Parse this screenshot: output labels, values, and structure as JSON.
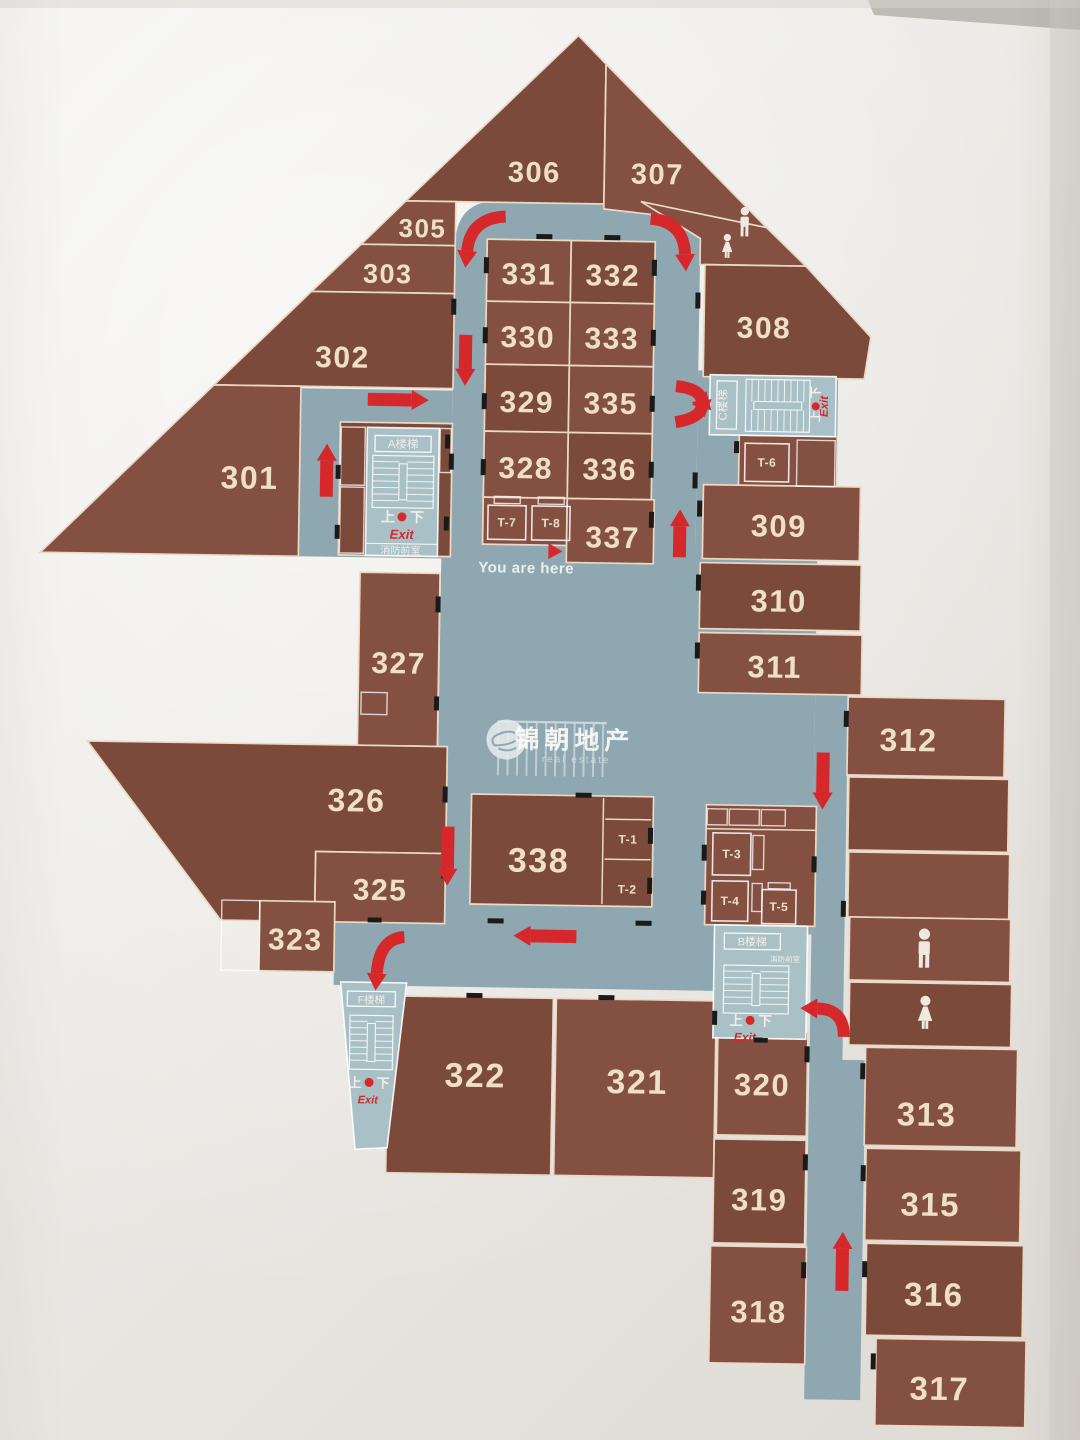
{
  "title": "3F floor plan directory",
  "palette": {
    "room": "#7c4a3b",
    "room_alt": "#835042",
    "corridor": "#8fa7b0",
    "stair_room": "#a9c0c7",
    "outline": "#ead9c4",
    "arrow_red": "#d6272b",
    "number_text": "#eedfc8",
    "black_door": "#1c1a18",
    "paper": "#eceae6"
  },
  "you_are_here": {
    "text": "You are here"
  },
  "labels": {
    "up": "上",
    "down": "下",
    "exit": "Exit",
    "fire_lobby": "消防前室",
    "stairA": "A楼梯",
    "stairB": "B楼梯",
    "stairC": "C楼梯",
    "stairF": "F楼梯"
  },
  "watermark": {
    "cn": "锦朝地产",
    "en": "real estate"
  },
  "rooms": [
    {
      "n": "306",
      "p": "575,35 603,63 603,203 405,203",
      "l": [
        533,
        172
      ],
      "fs": 29
    },
    {
      "n": "307",
      "p": "603,63 766,224 603,208",
      "l": [
        656,
        172
      ],
      "fs": 29
    },
    {
      "n": "",
      "name": "restroom-area-top",
      "p": "640,200 766,224 806,262 700,262 700,236"
    },
    {
      "n": "308",
      "p": "705,262 806,262 872,332 866,374 705,374",
      "l": [
        765,
        324
      ],
      "fs": 30
    },
    {
      "n": "305",
      "p": "405,203 455,203 455,247 361,247",
      "l": [
        422,
        230
      ],
      "fs": 26
    },
    {
      "n": "303",
      "p": "361,247 455,247 455,295 312,295",
      "l": [
        388,
        276
      ],
      "fs": 27
    },
    {
      "n": "302",
      "p": "312,295 455,295 455,390 216,390",
      "l": [
        344,
        360
      ],
      "fs": 30
    },
    {
      "n": "301",
      "p": "216,390 303,390 303,560 45,560",
      "l": [
        253,
        482
      ],
      "fs": 32
    },
    {
      "n": "331",
      "r": [
        487,
        240,
        84,
        62
      ],
      "l": [
        529,
        274
      ],
      "fs": 30
    },
    {
      "n": "332",
      "r": [
        571,
        240,
        84,
        62
      ],
      "l": [
        613,
        274
      ],
      "fs": 30
    },
    {
      "n": "330",
      "r": [
        487,
        302,
        84,
        63
      ],
      "l": [
        529,
        337
      ],
      "fs": 30
    },
    {
      "n": "333",
      "r": [
        571,
        302,
        84,
        63
      ],
      "l": [
        613,
        337
      ],
      "fs": 30
    },
    {
      "n": "329",
      "r": [
        487,
        365,
        84,
        67
      ],
      "l": [
        529,
        402
      ],
      "fs": 30
    },
    {
      "n": "335",
      "r": [
        571,
        365,
        84,
        67
      ],
      "l": [
        613,
        402
      ],
      "fs": 30
    },
    {
      "n": "328",
      "r": [
        487,
        432,
        84,
        66
      ],
      "l": [
        529,
        468
      ],
      "fs": 30
    },
    {
      "n": "336",
      "r": [
        571,
        432,
        84,
        66
      ],
      "l": [
        613,
        468
      ],
      "fs": 30
    },
    {
      "n": "",
      "name": "elevator-block-t7-t8",
      "r": [
        487,
        498,
        84,
        47
      ]
    },
    {
      "n": "337",
      "r": [
        571,
        498,
        87,
        64
      ],
      "l": [
        617,
        536
      ],
      "fs": 30
    },
    {
      "n": "",
      "name": "stair-a-block",
      "r": [
        343,
        425,
        112,
        133
      ]
    },
    {
      "n": "",
      "name": "elevator-t6-block",
      "r": [
        742,
        432,
        98,
        52
      ]
    },
    {
      "n": "309",
      "r": [
        707,
        482,
        157,
        74
      ],
      "l": [
        783,
        522
      ],
      "fs": 31
    },
    {
      "n": "310",
      "r": [
        705,
        560,
        161,
        66
      ],
      "l": [
        784,
        597
      ],
      "fs": 31
    },
    {
      "n": "311",
      "r": [
        705,
        630,
        163,
        60
      ],
      "l": [
        781,
        663
      ],
      "fs": 31
    },
    {
      "n": "312",
      "r": [
        855,
        692,
        157,
        78
      ],
      "l": [
        916,
        734
      ],
      "fs": 32
    },
    {
      "n": "",
      "name": "room-unlabeled-1",
      "r": [
        857,
        772,
        160,
        73
      ]
    },
    {
      "n": "",
      "name": "room-unlabeled-2",
      "r": [
        858,
        847,
        161,
        65
      ]
    },
    {
      "n": "",
      "name": "restroom-men",
      "r": [
        860,
        912,
        161,
        63
      ]
    },
    {
      "n": "",
      "name": "restroom-women",
      "r": [
        861,
        977,
        162,
        63
      ]
    },
    {
      "n": "313",
      "r": [
        878,
        1042,
        152,
        98
      ],
      "l": [
        940,
        1108
      ],
      "fs": 33
    },
    {
      "n": "315",
      "r": [
        880,
        1143,
        155,
        92
      ],
      "l": [
        945,
        1198
      ],
      "fs": 33
    },
    {
      "n": "316",
      "r": [
        882,
        1238,
        157,
        92
      ],
      "l": [
        950,
        1288
      ],
      "fs": 33
    },
    {
      "n": "317",
      "r": [
        893,
        1333,
        150,
        87
      ],
      "l": [
        957,
        1382
      ],
      "fs": 33
    },
    {
      "n": "327",
      "r": [
        365,
        575,
        80,
        173
      ],
      "l": [
        405,
        665
      ],
      "fs": 30
    },
    {
      "n": "326",
      "p": "95,748 455,748 455,855 325,855 325,925 231,925",
      "l": [
        365,
        803
      ],
      "fs": 32
    },
    {
      "n": "325",
      "r": [
        325,
        855,
        130,
        70
      ],
      "l": [
        390,
        892
      ],
      "fs": 30
    },
    {
      "n": "323",
      "r": [
        270,
        905,
        75,
        70
      ],
      "l": [
        306,
        943
      ],
      "fs": 30
    },
    {
      "n": "322",
      "r": [
        400,
        998,
        165,
        177
      ],
      "l": [
        488,
        1076
      ],
      "fs": 34
    },
    {
      "n": "321",
      "r": [
        568,
        998,
        160,
        177
      ],
      "l": [
        650,
        1080
      ],
      "fs": 34
    },
    {
      "n": "320",
      "r": [
        730,
        1028,
        90,
        104
      ],
      "l": [
        775,
        1081
      ],
      "fs": 31
    },
    {
      "n": "319",
      "r": [
        728,
        1136,
        92,
        104
      ],
      "l": [
        774,
        1196
      ],
      "fs": 31
    },
    {
      "n": "318",
      "r": [
        726,
        1243,
        96,
        117
      ],
      "l": [
        775,
        1308
      ],
      "fs": 31
    },
    {
      "n": "",
      "name": "elevator-block-t3-t4-t5",
      "r": [
        715,
        802,
        110,
        120
      ]
    },
    {
      "n": "338",
      "r": [
        480,
        795,
        182,
        110
      ],
      "l": [
        548,
        860
      ],
      "fs": 34
    }
  ],
  "elevators": [
    {
      "n": "T-7",
      "r": [
        492,
        506,
        38,
        34
      ],
      "l": [
        511,
        527
      ],
      "tab": [
        498,
        497,
        26,
        7
      ]
    },
    {
      "n": "T-8",
      "r": [
        536,
        506,
        38,
        34
      ],
      "l": [
        555,
        527
      ],
      "tab": [
        542,
        497,
        26,
        7
      ]
    },
    {
      "n": "T-6",
      "r": [
        748,
        440,
        44,
        38
      ],
      "l": [
        770,
        463
      ]
    },
    {
      "n": "T-1",
      "l": [
        637,
        842
      ]
    },
    {
      "n": "T-2",
      "l": [
        637,
        892
      ]
    },
    {
      "n": "T-3",
      "r": [
        722,
        830,
        38,
        42
      ],
      "l": [
        741,
        855
      ]
    },
    {
      "n": "T-4",
      "r": [
        722,
        878,
        36,
        40
      ],
      "l": [
        740,
        902
      ]
    },
    {
      "n": "T-5",
      "r": [
        772,
        886,
        34,
        34
      ],
      "l": [
        789,
        907
      ],
      "tab": [
        778,
        879,
        22,
        6
      ]
    }
  ],
  "corridors": {
    "ring_path": "M455,560 L455,246 Q455,201 501,201 L654,201 Q700,201 700,246 L700,560 Z",
    "rects": [
      [
        303,
        392,
        152,
        168
      ],
      [
        700,
        368,
        140,
        66
      ],
      [
        700,
        432,
        42,
        115
      ],
      [
        446,
        545,
        376,
        385
      ],
      [
        345,
        920,
        380,
        68
      ]
    ],
    "polys": [
      "822,688 855,688 855,1055 878,1055 878,1395 822,1395"
    ]
  },
  "stair_f_poly": "352,985 418,985 401,1150 369,1152",
  "arrows": {
    "straight": [
      [
        467,
        336,
        467,
        384
      ],
      [
        330,
        500,
        330,
        450
      ],
      [
        370,
        402,
        428,
        402
      ],
      [
        684,
        555,
        684,
        510
      ],
      [
        457,
        828,
        457,
        884
      ],
      [
        587,
        936,
        527,
        936
      ],
      [
        831,
        748,
        831,
        802
      ],
      [
        858,
        1286,
        858,
        1230
      ]
    ],
    "curved": [
      [
        505,
        217,
        470,
        219,
        467,
        252
      ],
      [
        650,
        217,
        683,
        219,
        685,
        252
      ],
      [
        678,
        384,
        702,
        386,
        704,
        398
      ],
      [
        678,
        420,
        701,
        416,
        704,
        405
      ],
      [
        856,
        1032,
        856,
        1004,
        829,
        1004
      ],
      [
        415,
        939,
        390,
        941,
        388,
        976
      ]
    ]
  },
  "door_ticks": [
    [
      452,
      300,
      5,
      16
    ],
    [
      452,
      455,
      5,
      16
    ],
    [
      484,
      258,
      5,
      16
    ],
    [
      484,
      328,
      5,
      16
    ],
    [
      484,
      394,
      5,
      16
    ],
    [
      484,
      460,
      5,
      16
    ],
    [
      652,
      258,
      5,
      16
    ],
    [
      652,
      328,
      5,
      16
    ],
    [
      652,
      394,
      5,
      16
    ],
    [
      652,
      460,
      5,
      16
    ],
    [
      696,
      290,
      5,
      16
    ],
    [
      696,
      470,
      5,
      16
    ],
    [
      653,
      510,
      5,
      16
    ],
    [
      448,
      436,
      5,
      14
    ],
    [
      448,
      518,
      5,
      14
    ],
    [
      339,
      468,
      5,
      14
    ],
    [
      339,
      528,
      5,
      14
    ],
    [
      701,
      498,
      5,
      16
    ],
    [
      701,
      572,
      5,
      16
    ],
    [
      701,
      640,
      5,
      16
    ],
    [
      737,
      438,
      5,
      12
    ],
    [
      851,
      706,
      5,
      16
    ],
    [
      851,
      896,
      5,
      16
    ],
    [
      873,
      1058,
      5,
      16
    ],
    [
      875,
      1160,
      5,
      16
    ],
    [
      878,
      1256,
      5,
      16
    ],
    [
      888,
      1348,
      5,
      16
    ],
    [
      817,
      1042,
      5,
      16
    ],
    [
      817,
      1150,
      5,
      16
    ],
    [
      817,
      1258,
      5,
      16
    ],
    [
      657,
      826,
      5,
      16
    ],
    [
      657,
      876,
      5,
      16
    ],
    [
      711,
      842,
      5,
      16
    ],
    [
      711,
      888,
      5,
      14
    ],
    [
      821,
      852,
      5,
      16
    ],
    [
      441,
      598,
      5,
      16
    ],
    [
      441,
      698,
      5,
      14
    ],
    [
      451,
      788,
      5,
      16
    ],
    [
      451,
      866,
      5,
      14
    ],
    [
      724,
      1008,
      5,
      14
    ],
    [
      536,
      234,
      16,
      5
    ],
    [
      604,
      234,
      16,
      5
    ],
    [
      478,
      994,
      16,
      5
    ],
    [
      610,
      994,
      16,
      5
    ],
    [
      498,
      919,
      16,
      5
    ],
    [
      646,
      919,
      16,
      5
    ],
    [
      584,
      792,
      16,
      5
    ],
    [
      766,
      1034,
      14,
      5
    ],
    [
      378,
      920,
      14,
      5
    ]
  ],
  "decor_outlines": [
    [
      344,
      430,
      24,
      58
    ],
    [
      344,
      490,
      24,
      66
    ],
    [
      443,
      430,
      11,
      44
    ],
    [
      368,
      695,
      26,
      22
    ],
    [
      232,
      905,
      38,
      70
    ],
    [
      716,
      806,
      20,
      16
    ],
    [
      738,
      806,
      30,
      16
    ],
    [
      770,
      806,
      24,
      16
    ],
    [
      762,
      832,
      11,
      34
    ],
    [
      762,
      880,
      10,
      28
    ],
    [
      800,
      436,
      38,
      46
    ]
  ],
  "decor_lines": [
    [
      715,
      826,
      825,
      826
    ],
    [
      612,
      797,
      612,
      903
    ],
    [
      614,
      818,
      660,
      818
    ],
    [
      614,
      858,
      660,
      858
    ]
  ],
  "toilets": [
    {
      "t": "m",
      "x": 744,
      "y": 220,
      "h": 30
    },
    {
      "t": "f",
      "x": 727,
      "y": 245,
      "h": 26
    },
    {
      "t": "m",
      "x": 935,
      "y": 944,
      "h": 40
    },
    {
      "t": "f",
      "x": 937,
      "y": 1009,
      "h": 36
    }
  ]
}
